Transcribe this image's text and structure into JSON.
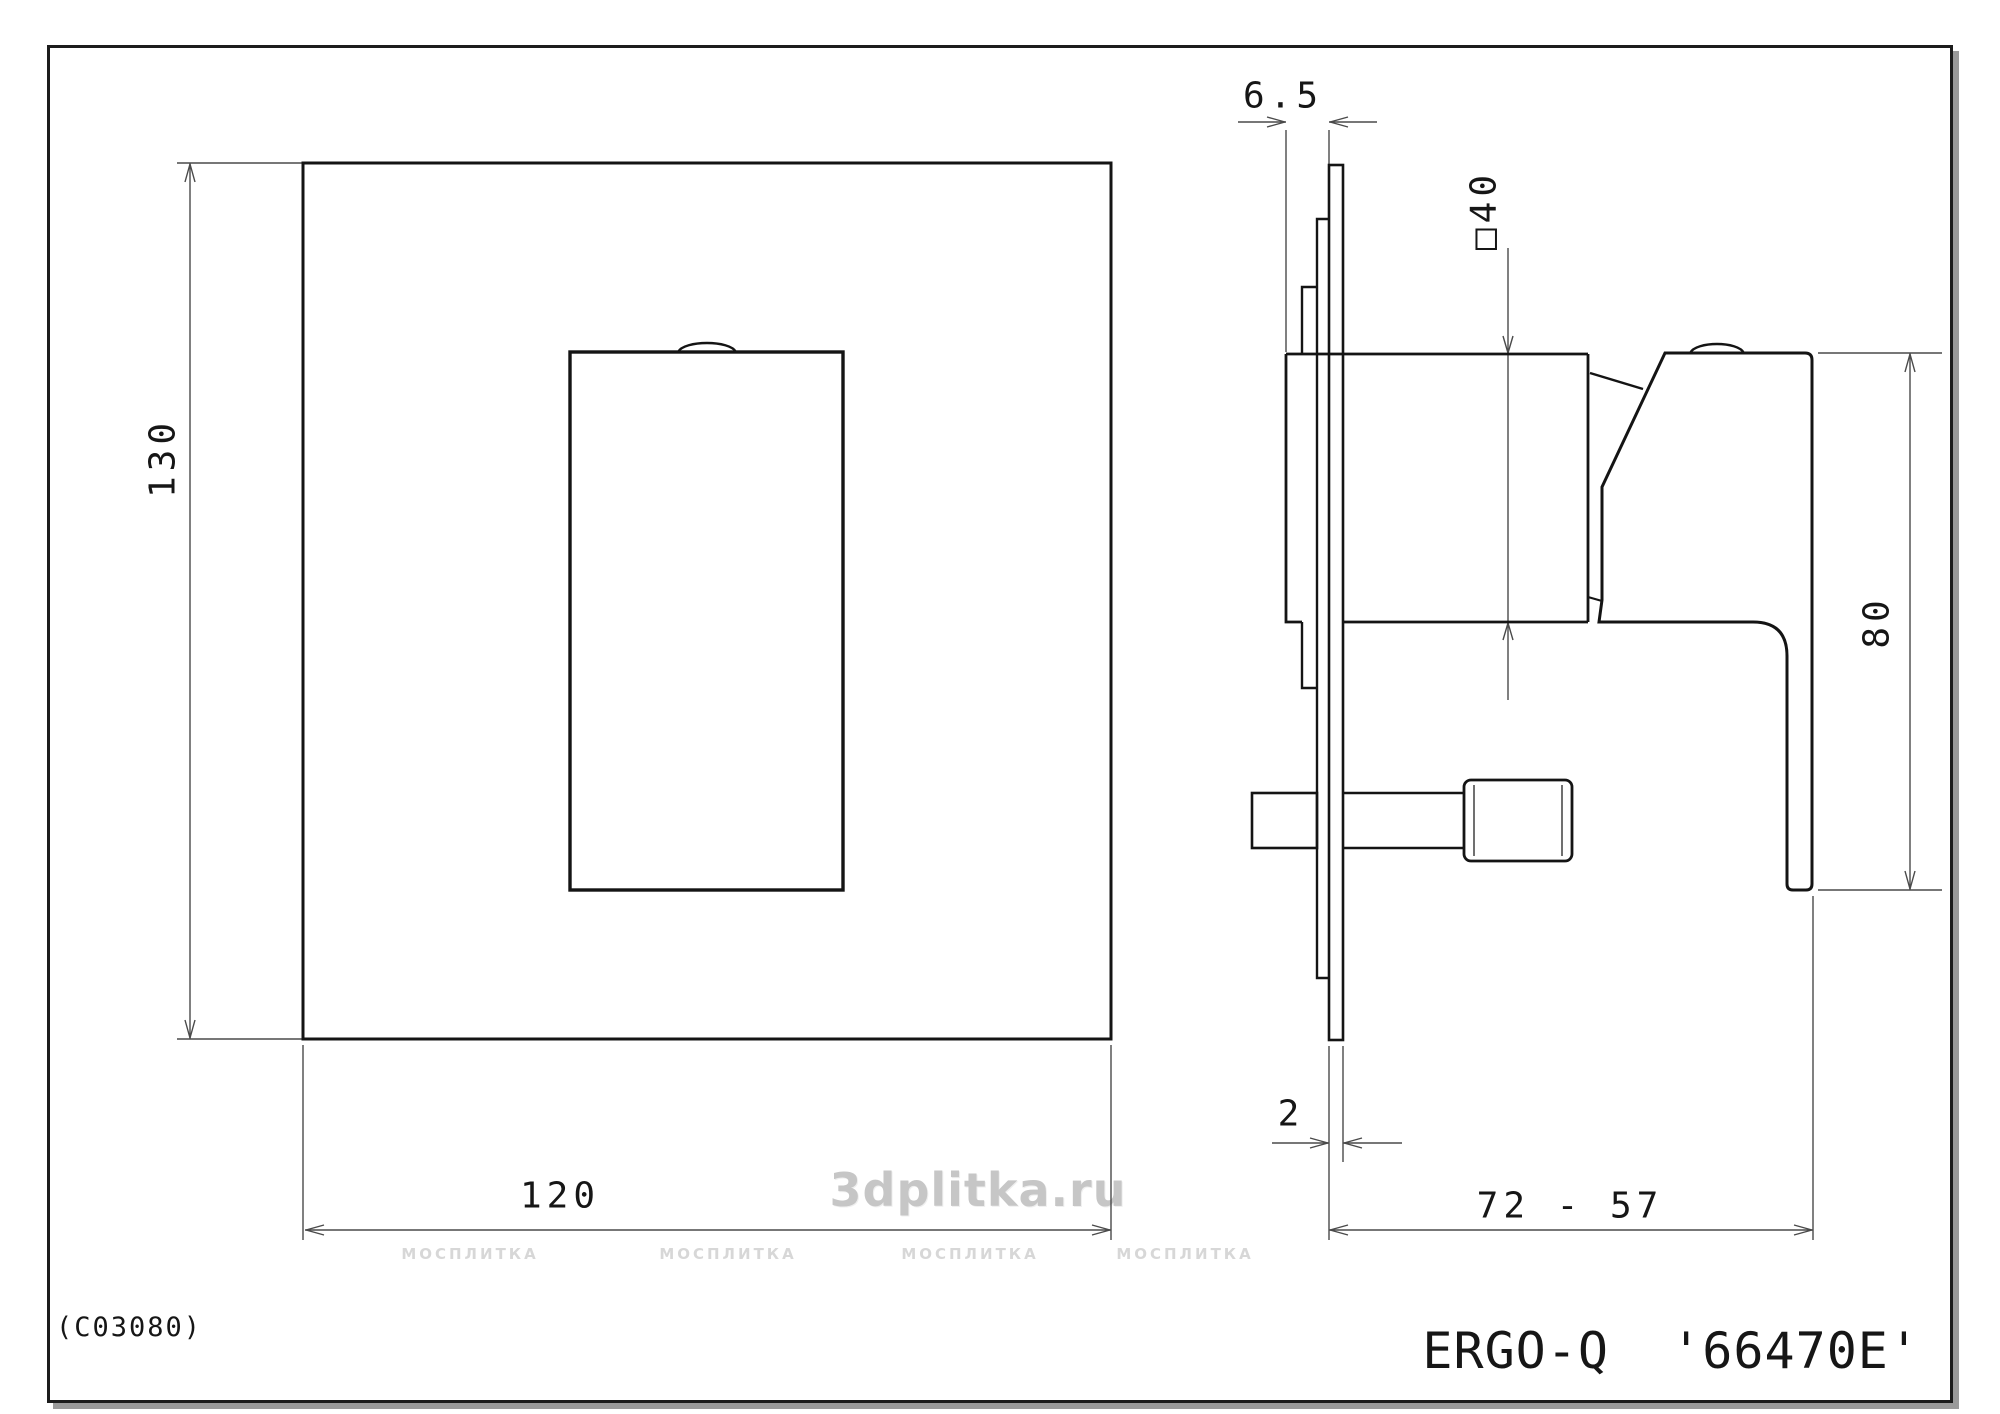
{
  "drawing": {
    "code": "(C03080)",
    "title": "ERGO-Q  '66470E'",
    "watermark_main": "3dplitka.ru",
    "watermark_tile": "МОСПЛИТКА",
    "views": {
      "front": "front view of square trim plate with lever",
      "side": "side profile with wall plate and lever"
    },
    "dims": {
      "height": "130",
      "width": "120",
      "plate_offset": "6.5",
      "body_size": "□40",
      "lever_length": "80",
      "plate_thickness": "2",
      "depth_range": "72 - 57"
    }
  }
}
